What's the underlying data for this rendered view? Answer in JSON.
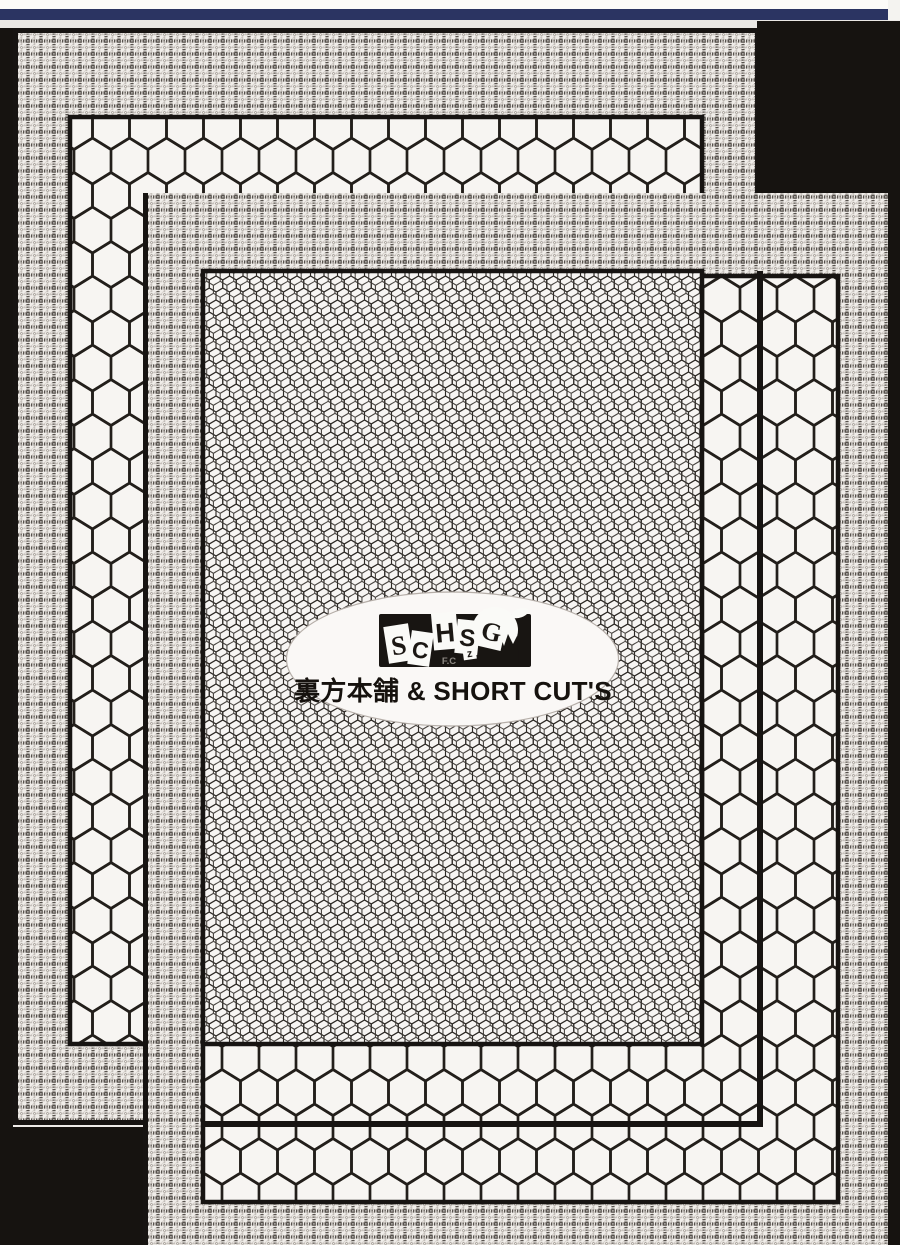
{
  "scan": {
    "description": "Scanned doujinshi back cover: two overlapping patterned pages on a black background",
    "colors": {
      "top_bar_navy": "#2b3462",
      "page_black": "#171412",
      "paper": "#f7f5f3",
      "pattern_line": "#231f1b"
    },
    "patterns": {
      "border": "plaid weave",
      "band": "large honeycomb",
      "interior": "fine double honeycomb mesh"
    }
  },
  "logo": {
    "letters": [
      "S",
      "C",
      "H",
      "S",
      "G"
    ],
    "small_letter": "z",
    "sub_label": "F.C",
    "title": "裏方本舗 & SHORT CUT'S"
  }
}
